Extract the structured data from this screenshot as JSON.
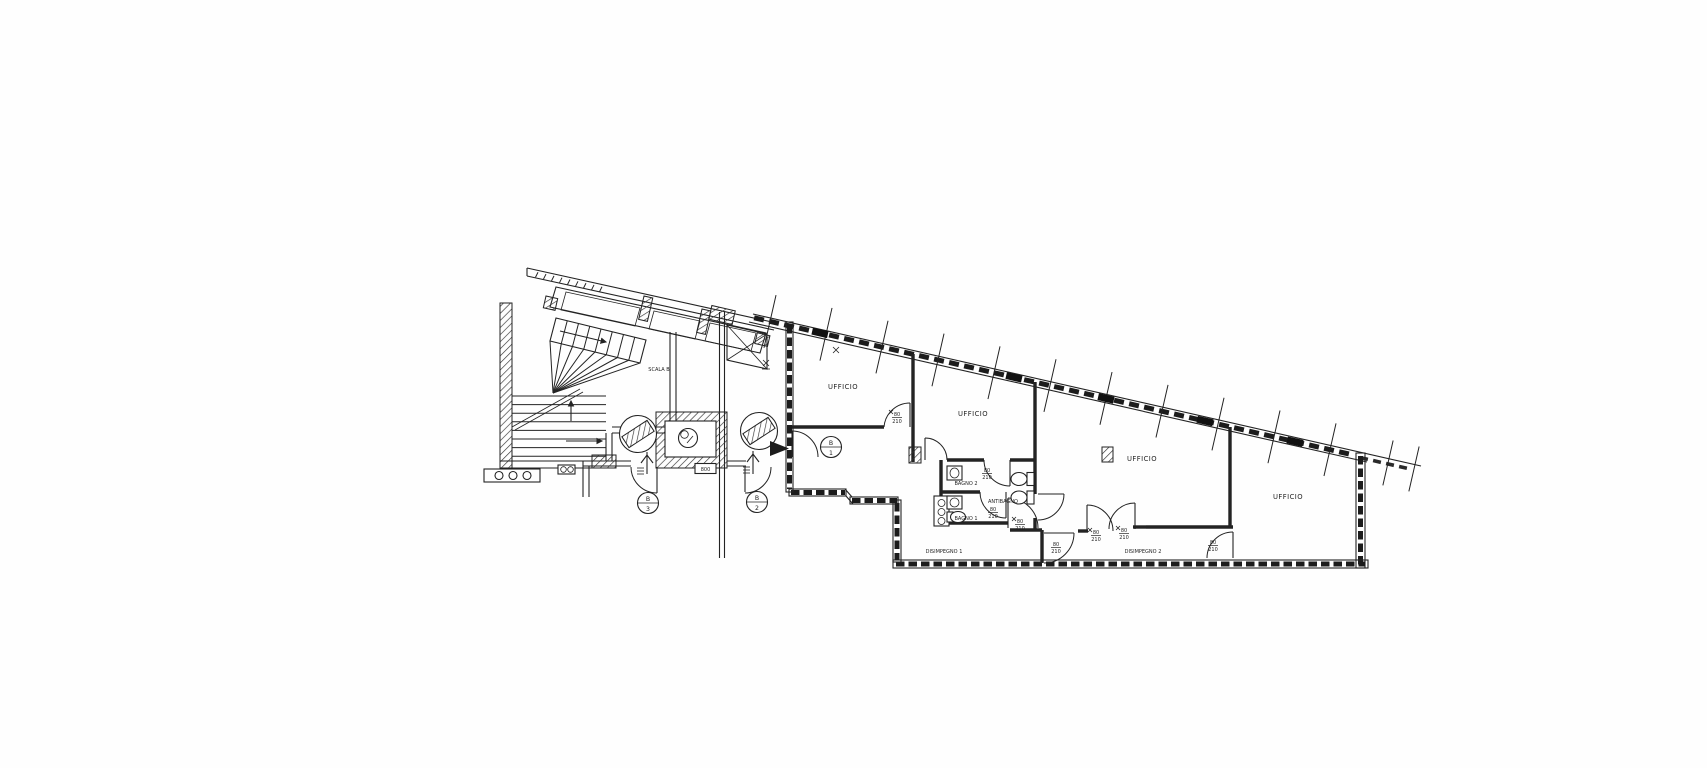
{
  "labels": {
    "scala_b": "SCALA B",
    "ufficio_1": "UFFICIO",
    "ufficio_2": "UFFICIO",
    "ufficio_3": "UFFICIO",
    "ufficio_4": "UFFICIO",
    "bagno_2": "BAGNO 2",
    "bagno_1": "BAGNO 1",
    "antibagno": "ANTIBAGNO",
    "disimpegno_1": "DISIMPEGNO 1",
    "disimpegno_2": "DISIMPEGNO 2",
    "elevator_size": "800"
  },
  "door_dim": {
    "width": "80",
    "height": "210"
  },
  "tags": {
    "b1": {
      "letter": "B",
      "number": "1"
    },
    "b2": {
      "letter": "B",
      "number": "2"
    },
    "b3": {
      "letter": "B",
      "number": "3"
    }
  },
  "colors": {
    "ink": "#232323",
    "paper": "#ffffff"
  }
}
